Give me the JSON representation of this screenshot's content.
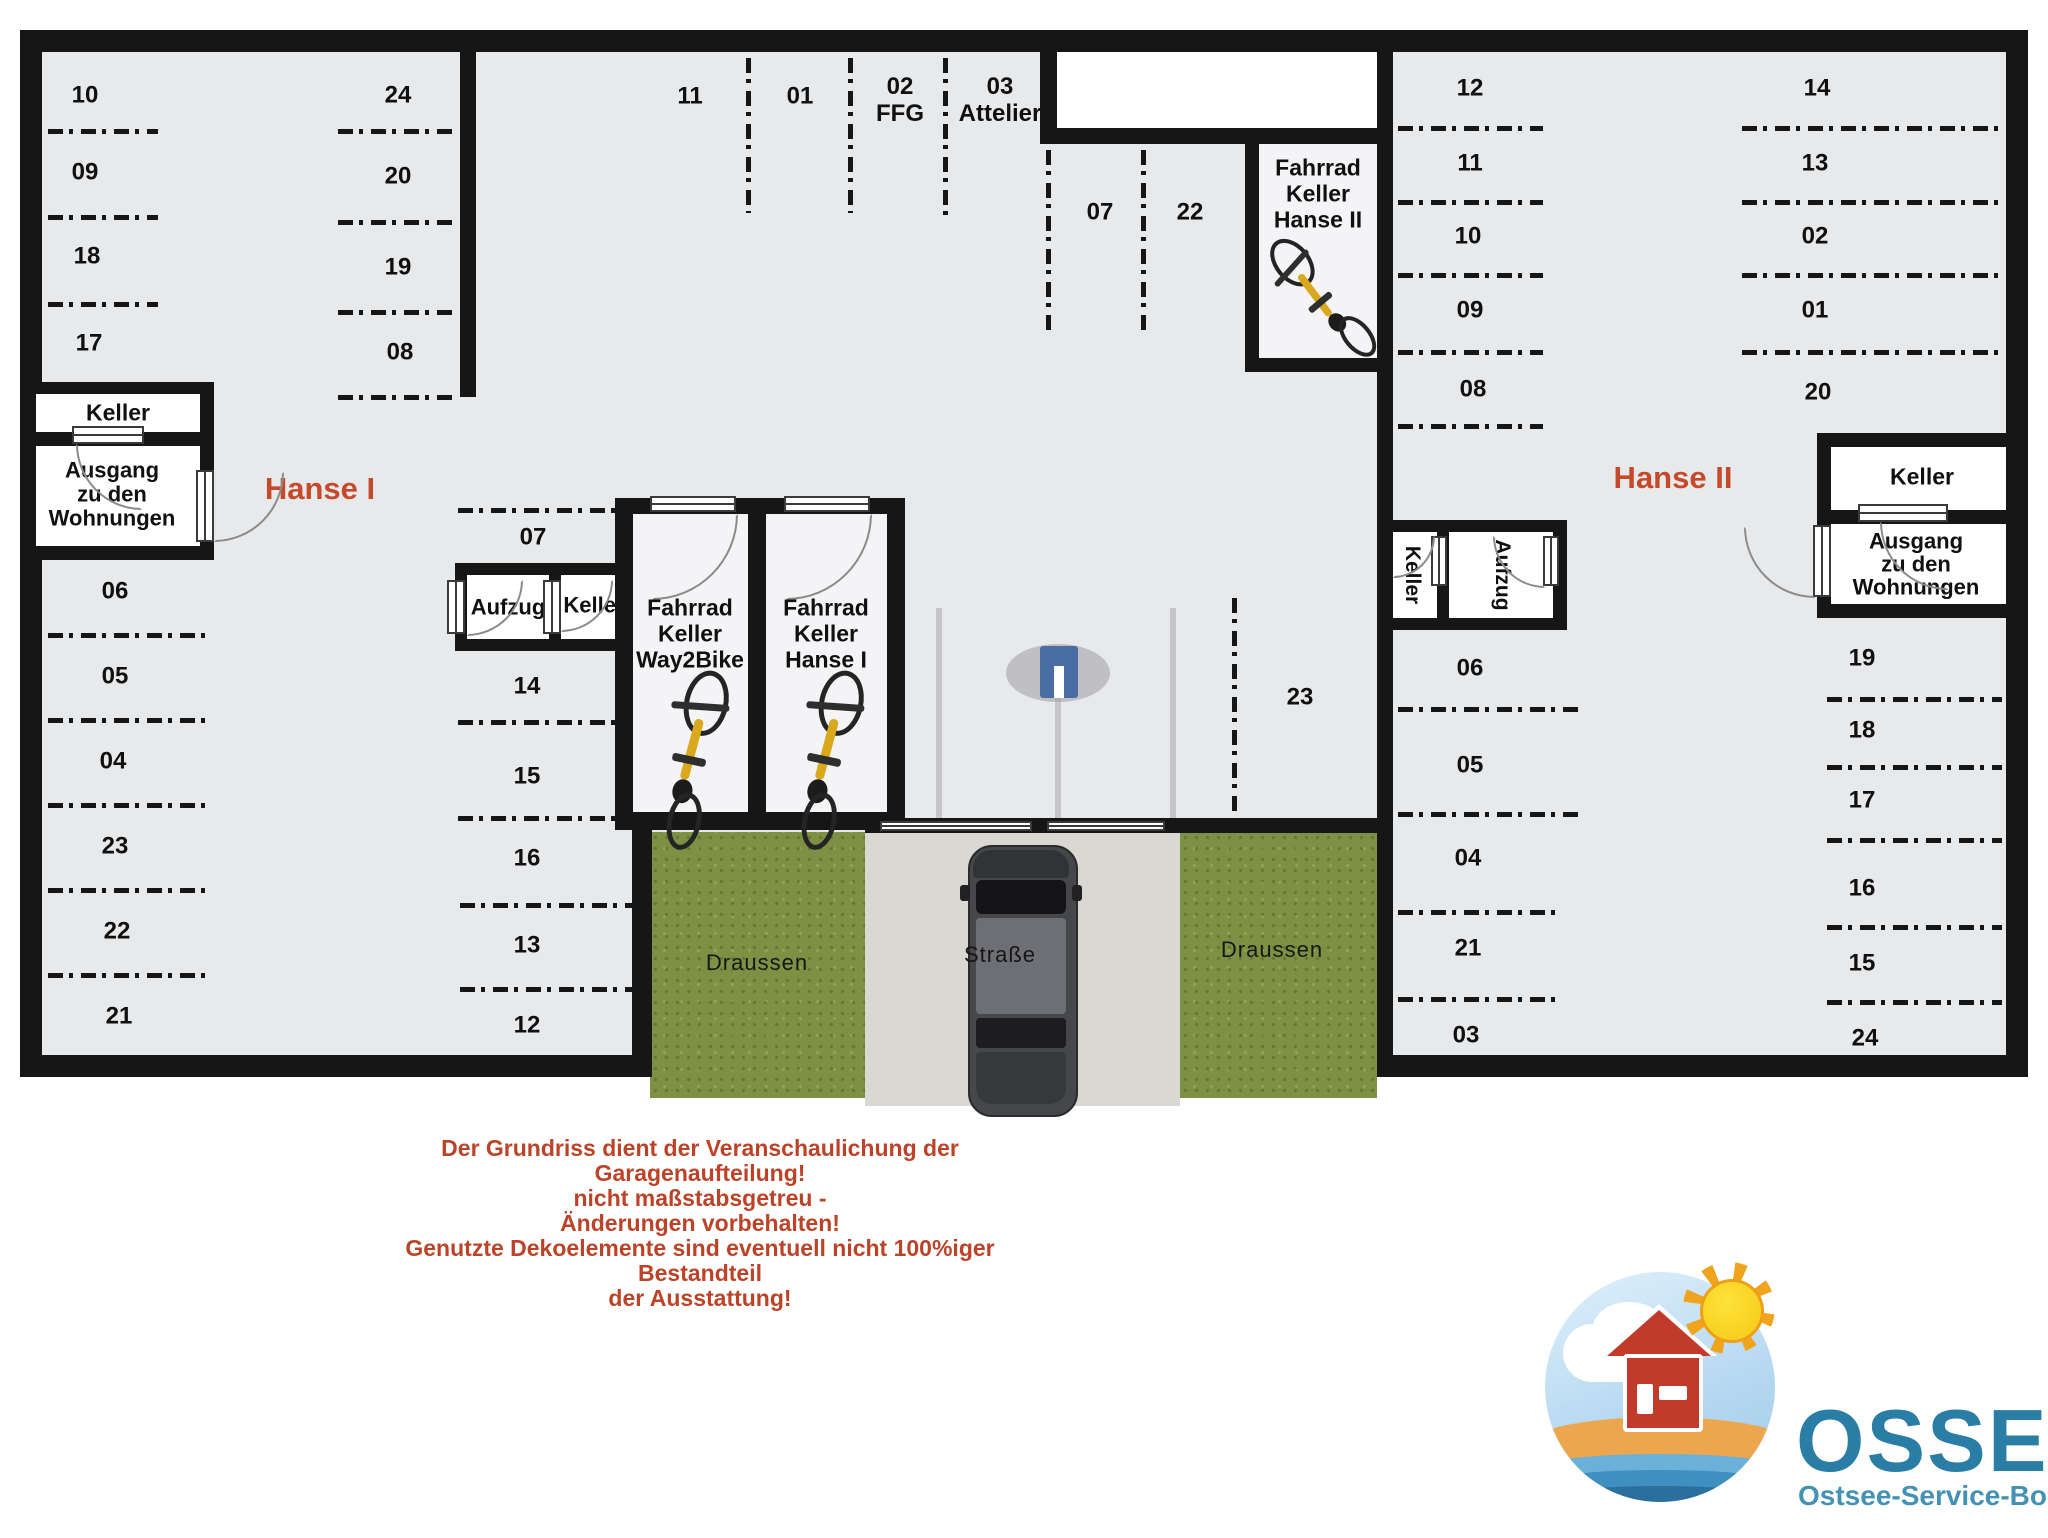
{
  "buildings": {
    "hanse1": "Hanse I",
    "hanse2": "Hanse II"
  },
  "rooms": {
    "keller": "Keller",
    "aufzug": "Aufzug",
    "ausgang": [
      "Ausgang",
      "zu den",
      "Wohnungen"
    ],
    "fahrrad_way2bike": [
      "Fahrrad",
      "Keller",
      "Way2Bike"
    ],
    "fahrrad_hanse1": [
      "Fahrrad",
      "Keller",
      "Hanse I"
    ],
    "fahrrad_hanse2": [
      "Fahrrad",
      "Keller",
      "Hanse II"
    ]
  },
  "spots": {
    "h1_col_a": [
      "10",
      "09",
      "18",
      "17"
    ],
    "h1_col_b": [
      "24",
      "20",
      "19",
      "08"
    ],
    "h1_top_row": [
      {
        "num": "11",
        "sub": ""
      },
      {
        "num": "01",
        "sub": ""
      },
      {
        "num": "02",
        "sub": "FFG"
      },
      {
        "num": "03",
        "sub": "Attelier"
      }
    ],
    "h1_mid": [
      "07",
      "22"
    ],
    "h1_col_e": [
      "06",
      "05",
      "04",
      "23",
      "22",
      "21"
    ],
    "h1_col_f": [
      "07",
      "14",
      "15",
      "16",
      "13",
      "12"
    ],
    "h2_col_c": [
      "12",
      "11",
      "10",
      "09",
      "08"
    ],
    "h2_col_d": [
      "14",
      "13",
      "02",
      "01",
      "20"
    ],
    "h2_col_g": [
      "06",
      "05",
      "04",
      "21",
      "03"
    ],
    "h2_col_h": [
      "19",
      "18",
      "17",
      "16",
      "15",
      "24"
    ],
    "h2_lane_spot": "23"
  },
  "outside": {
    "draussen_left": "Draussen",
    "draussen_right": "Draussen",
    "strasse": "Straße"
  },
  "disclaimer": {
    "line1": "Der Grundriss dient der Veranschaulichung der Garagenaufteilung!",
    "line2": "nicht maßstabsgetreu -",
    "line3": "Änderungen vorbehalten!",
    "line4": "Genutzte Dekoelemente sind eventuell nicht 100%iger Bestandteil",
    "line5": "der Ausstattung!"
  },
  "logo": {
    "brand": "OSSEBO",
    "subtitle": "Ostsee-Service-Boltenhagen GmbH"
  },
  "colors": {
    "wall": "#161616",
    "floor": "#e8e9eb",
    "accent_red": "#c44a2b",
    "grass_green": "#7d9043",
    "road_gray": "#d9d8d2",
    "gate_blue": "#4a6da6",
    "logo_teal": "#2a7ea6"
  }
}
